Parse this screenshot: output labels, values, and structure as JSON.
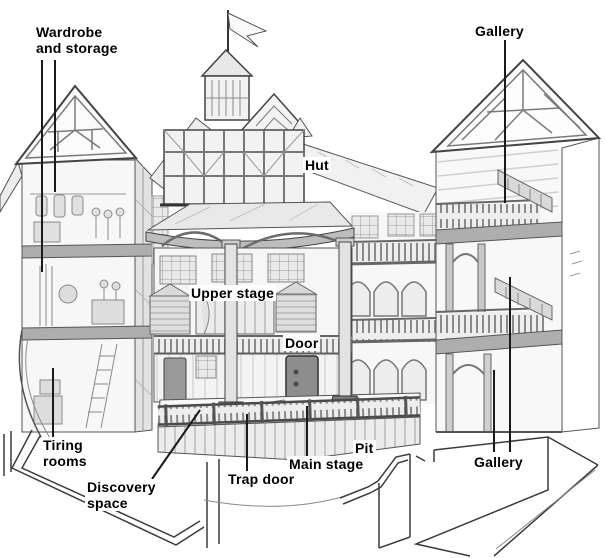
{
  "labels": {
    "wardrobe": "Wardrobe\nand storage",
    "gallery_top": "Gallery",
    "hut": "Hut",
    "upper_stage": "Upper stage",
    "door": "Door",
    "tiring_rooms": "Tiring\nrooms",
    "discovery_space": "Discovery\nspace",
    "trap_door": "Trap door",
    "main_stage": "Main stage",
    "pit": "Pit",
    "gallery_bottom": "Gallery"
  },
  "colors": {
    "ink": "#3a3a3a",
    "paper": "#ffffff",
    "light_fill": "#f1f1f1",
    "mid_fill": "#d8d8d8",
    "beam": "#b0b0b0",
    "door": "#8d8d8d"
  }
}
